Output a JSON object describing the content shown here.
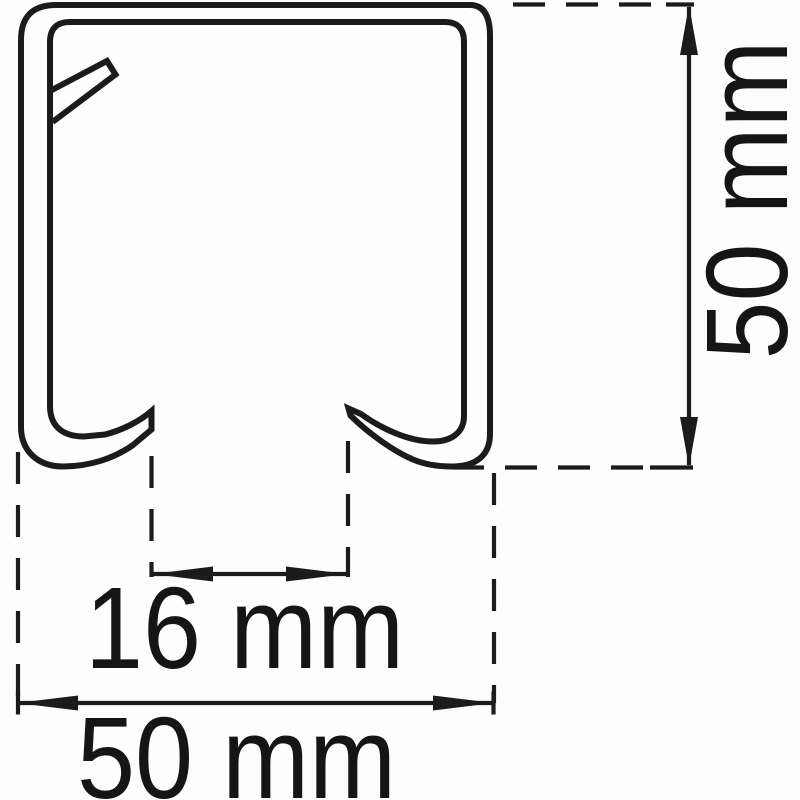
{
  "page": {
    "background_color": "#fdfdfd",
    "line_color": "#1b1b1b",
    "text_color": "#151515"
  },
  "diagram": {
    "type": "technical-cross-section",
    "subject": "C-channel mounting rail profile cross-section with curled bottom lips and inner snap tab",
    "units": "mm",
    "dimensions": [
      {
        "name": "overall-height",
        "label": "50 mm",
        "value": 50,
        "unit": "mm",
        "orientation": "vertical",
        "position": "right"
      },
      {
        "name": "slot-opening-width",
        "label": "16 mm",
        "value": 16,
        "unit": "mm",
        "orientation": "horizontal",
        "position": "bottom-center"
      },
      {
        "name": "overall-width",
        "label": "50 mm",
        "value": 50,
        "unit": "mm",
        "orientation": "horizontal",
        "position": "bottom"
      }
    ]
  }
}
